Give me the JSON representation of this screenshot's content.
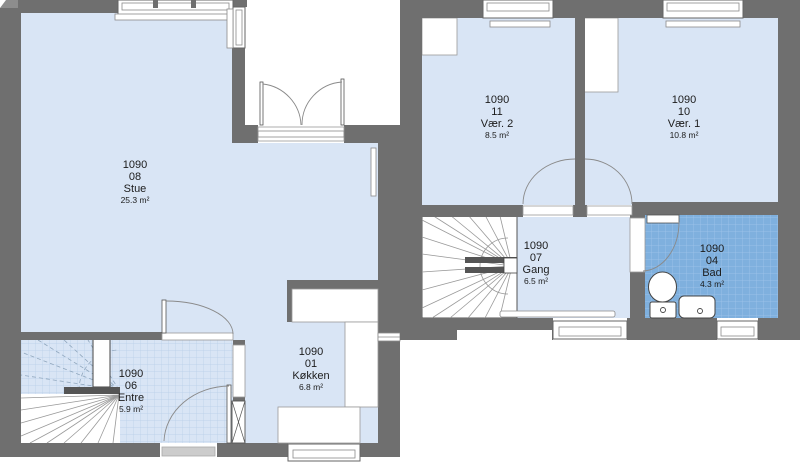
{
  "plan_title": "Floor plan unit 1090",
  "rooms": {
    "stue": {
      "code": "1090",
      "number": "08",
      "name": "Stue",
      "area": "25.3 m²"
    },
    "koekken": {
      "code": "1090",
      "number": "01",
      "name": "Køkken",
      "area": "6.8 m²"
    },
    "entre": {
      "code": "1090",
      "number": "06",
      "name": "Entre",
      "area": "5.9 m²"
    },
    "vaer2": {
      "code": "1090",
      "number": "11",
      "name": "Vær. 2",
      "area": "8.5 m²"
    },
    "vaer1": {
      "code": "1090",
      "number": "10",
      "name": "Vær. 1",
      "area": "10.8 m²"
    },
    "gang": {
      "code": "1090",
      "number": "07",
      "name": "Gang",
      "area": "6.5 m²"
    },
    "bad": {
      "code": "1090",
      "number": "04",
      "name": "Bad",
      "area": "4.3 m²"
    }
  },
  "colors": {
    "wall": "#6f6f6f",
    "floor": "#d9e5f5",
    "bath_tile": "#7fb0de",
    "entre_tile_line": "#b7cee8",
    "background": "#ffffff"
  }
}
